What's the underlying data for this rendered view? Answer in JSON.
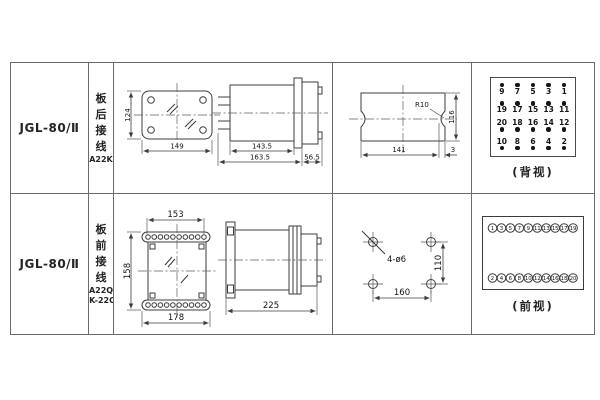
{
  "colors": {
    "background": "#ffffff",
    "table_border": "#6b6b6b",
    "drawing_line": "#3c3c3c",
    "text": "#1a1a1a"
  },
  "table": {
    "rows": [
      {
        "model": "JGL-80/Ⅱ",
        "mount_chars": [
          "板",
          "后",
          "接",
          "线"
        ],
        "mount_codes": [
          "A22K"
        ],
        "front_view": {
          "width": "149",
          "height": "124"
        },
        "side_view": {
          "body_len": "143.5",
          "total_len": "163.5",
          "rear_len": "56.5"
        },
        "panel_cutout": {
          "width": "141",
          "height": "116",
          "radius": "R10",
          "edge_offset": "3"
        },
        "terminal_view": {
          "label": "(背视)",
          "groups": [
            {
              "dot": "above",
              "nums": [
                "9",
                "7",
                "5",
                "3",
                "1"
              ]
            },
            {
              "dot": "above",
              "nums": [
                "19",
                "17",
                "15",
                "13",
                "11"
              ]
            },
            {
              "dot": "below",
              "nums": [
                "20",
                "18",
                "16",
                "14",
                "12"
              ]
            },
            {
              "dot": "below",
              "nums": [
                "10",
                "8",
                "6",
                "4",
                "2"
              ]
            }
          ]
        }
      },
      {
        "model": "JGL-80/Ⅱ",
        "mount_chars": [
          "板",
          "前",
          "接",
          "线"
        ],
        "mount_codes": [
          "A22Q",
          "JK-22Q"
        ],
        "front_view": {
          "hole_span": "153",
          "height": "158",
          "width": "178"
        },
        "side_view": {
          "total_len": "225"
        },
        "drill_plan": {
          "holes": "4-ø6",
          "v_span": "110",
          "h_span": "160"
        },
        "terminal_view": {
          "label": "(前视)",
          "top": [
            "1",
            "3",
            "5",
            "7",
            "9",
            "11",
            "13",
            "15",
            "17",
            "19"
          ],
          "bottom": [
            "2",
            "4",
            "6",
            "8",
            "10",
            "12",
            "14",
            "16",
            "18",
            "20"
          ]
        }
      }
    ]
  }
}
